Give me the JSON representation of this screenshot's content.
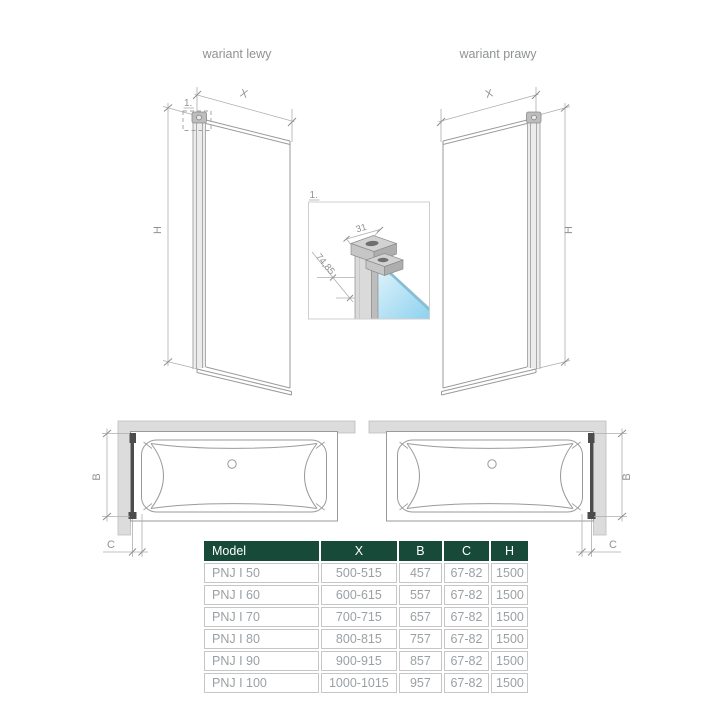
{
  "variants": {
    "left": "wariant lewy",
    "right": "wariant prawy"
  },
  "dim_labels": {
    "width": "X",
    "height": "H",
    "screen_width": "B",
    "clearance": "C"
  },
  "detail": {
    "callout": "1.",
    "profile_width": "31",
    "profile_depth": "74,85"
  },
  "table": {
    "headers": [
      "Model",
      "X",
      "B",
      "C",
      "H"
    ],
    "rows": [
      [
        "PNJ I 50",
        "500-515",
        "457",
        "67-82",
        "1500"
      ],
      [
        "PNJ I 60",
        "600-615",
        "557",
        "67-82",
        "1500"
      ],
      [
        "PNJ I 70",
        "700-715",
        "657",
        "67-82",
        "1500"
      ],
      [
        "PNJ I 80",
        "800-815",
        "757",
        "67-82",
        "1500"
      ],
      [
        "PNJ I 90",
        "900-915",
        "857",
        "67-82",
        "1500"
      ],
      [
        "PNJ I 100",
        "1000-1015",
        "957",
        "67-82",
        "1500"
      ]
    ]
  },
  "colors": {
    "table_header_bg": "#174a38",
    "table_text": "#9aa0a4",
    "table_border": "#c6c6c6",
    "drawing_line": "#9a9a9a",
    "dimension_line": "#a8a8a8",
    "label_text": "#8f9295",
    "screen_dark": "#4c4c4c",
    "wall_fill": "#dcdcdc",
    "glass_light": "#ddf2fb",
    "glass_dark": "#8ed2ee",
    "glass_edge": "#7ec0dc"
  }
}
